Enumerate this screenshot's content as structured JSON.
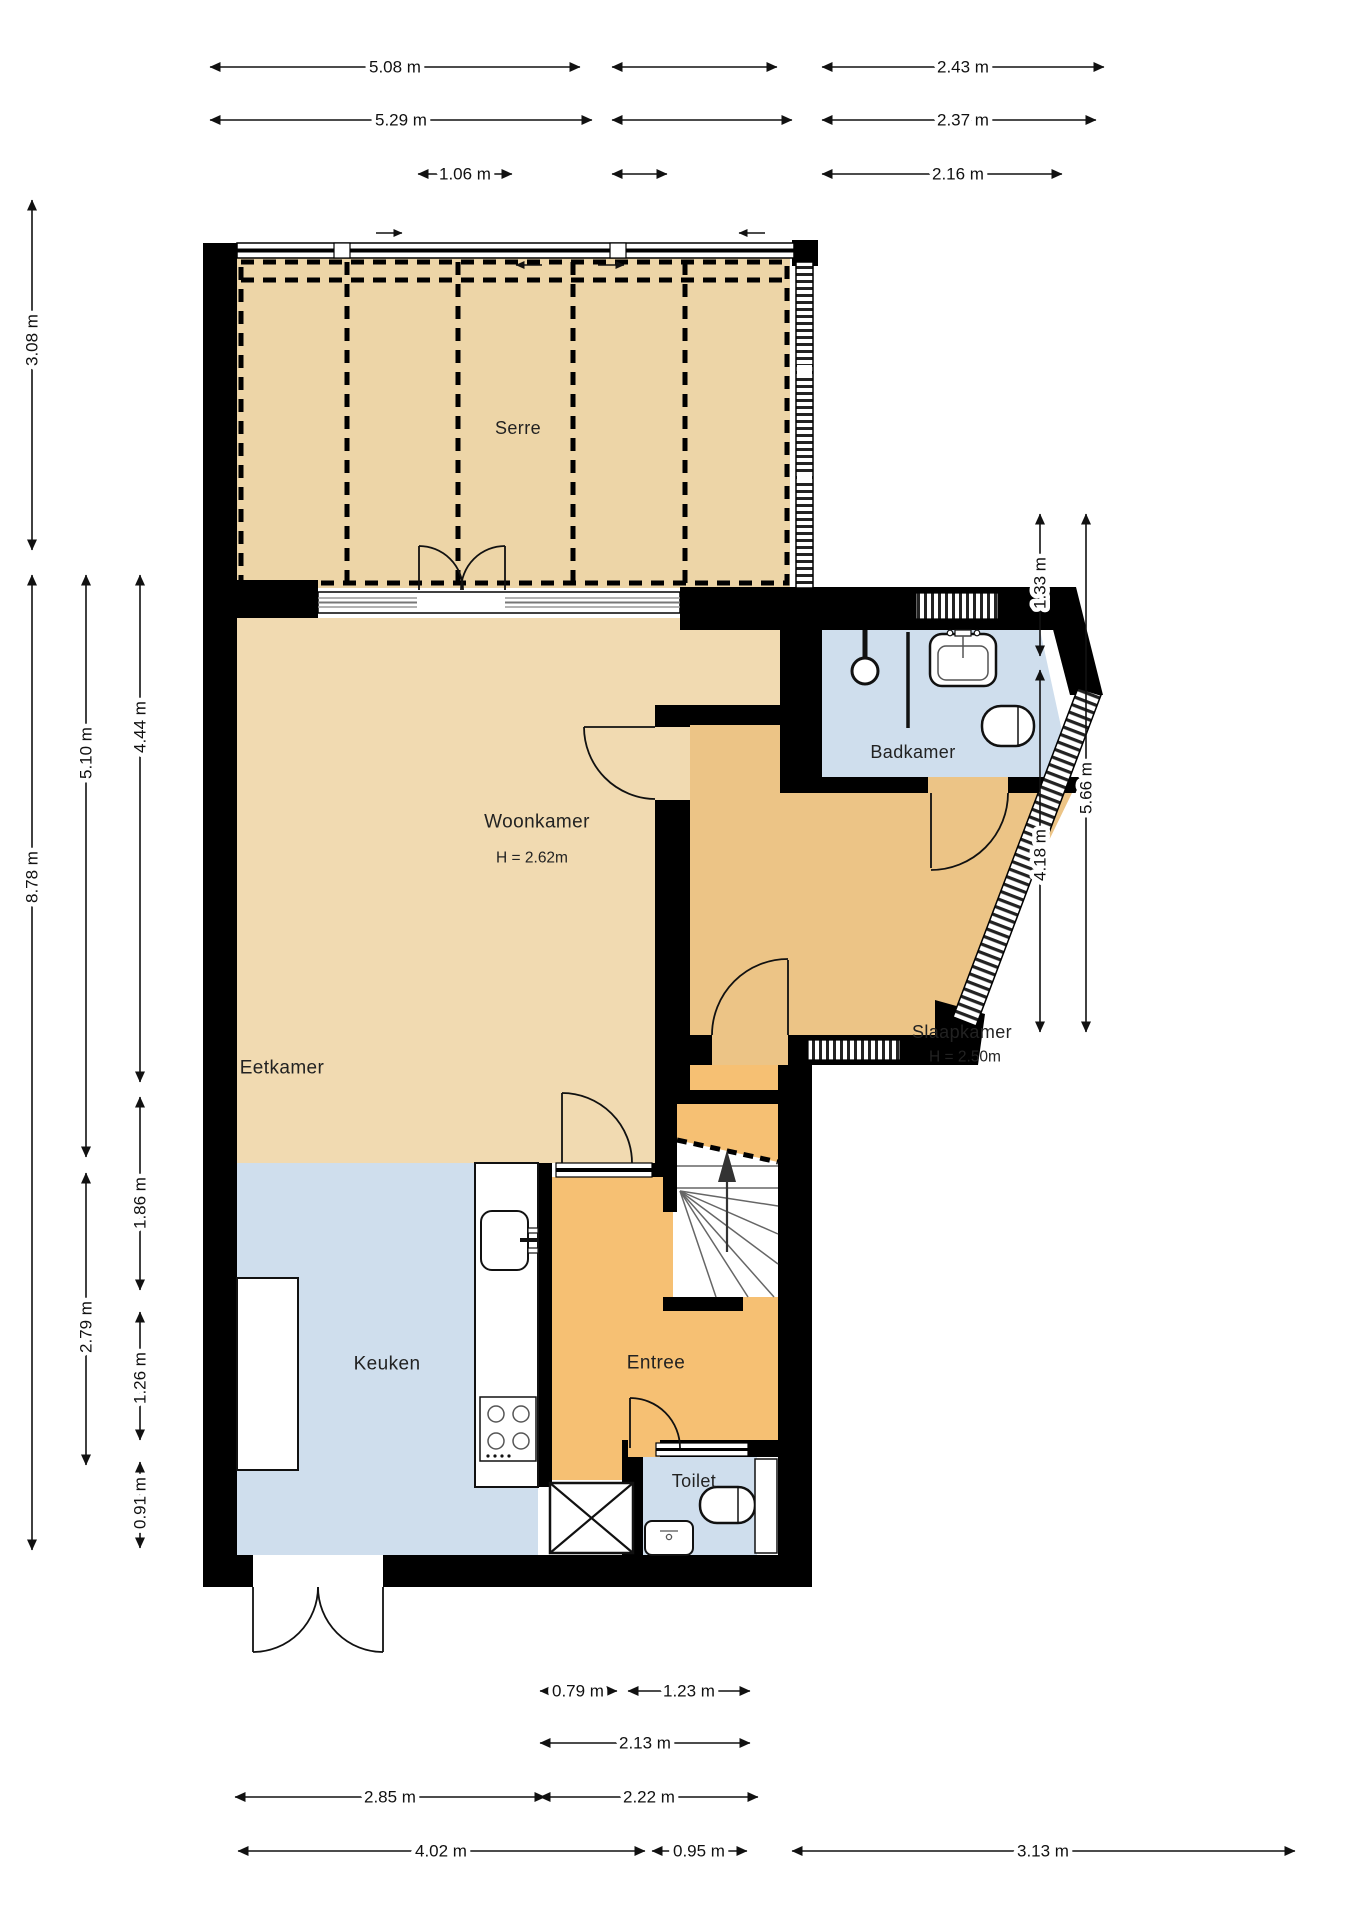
{
  "plan": {
    "type": "floorplan",
    "rooms": [
      {
        "id": "serre",
        "label": "Serre"
      },
      {
        "id": "woonkamer",
        "label": "Woonkamer",
        "height": "H = 2.62m"
      },
      {
        "id": "eetkamer",
        "label": "Eetkamer"
      },
      {
        "id": "badkamer",
        "label": "Badkamer"
      },
      {
        "id": "slaapkamer",
        "label": "Slaapkamer",
        "height": "H = 2.50m"
      },
      {
        "id": "keuken",
        "label": "Keuken"
      },
      {
        "id": "entree",
        "label": "Entree"
      },
      {
        "id": "toilet",
        "label": "Toilet"
      }
    ],
    "dimensions": {
      "top": [
        "5.08 m",
        "2.43 m",
        "5.29 m",
        "2.37 m",
        "1.06 m",
        "2.16 m"
      ],
      "bottom": [
        "0.79 m",
        "1.23 m",
        "2.13 m",
        "2.85 m",
        "2.22 m",
        "4.02 m",
        "0.95 m",
        "3.13 m"
      ],
      "left": [
        "3.08 m",
        "8.78 m",
        "5.10 m",
        "2.79 m",
        "4.44 m",
        "1.86 m",
        "1.26 m",
        "0.91 m"
      ],
      "right": [
        "1.33 m",
        "4.18 m",
        "5.66 m"
      ]
    },
    "colors": {
      "serre": "#edd5a7",
      "living": "#f1dab1",
      "bedroom": "#ecc486",
      "hall": "#f6c073",
      "wet": "#cfdeed",
      "wall": "#000000"
    }
  }
}
